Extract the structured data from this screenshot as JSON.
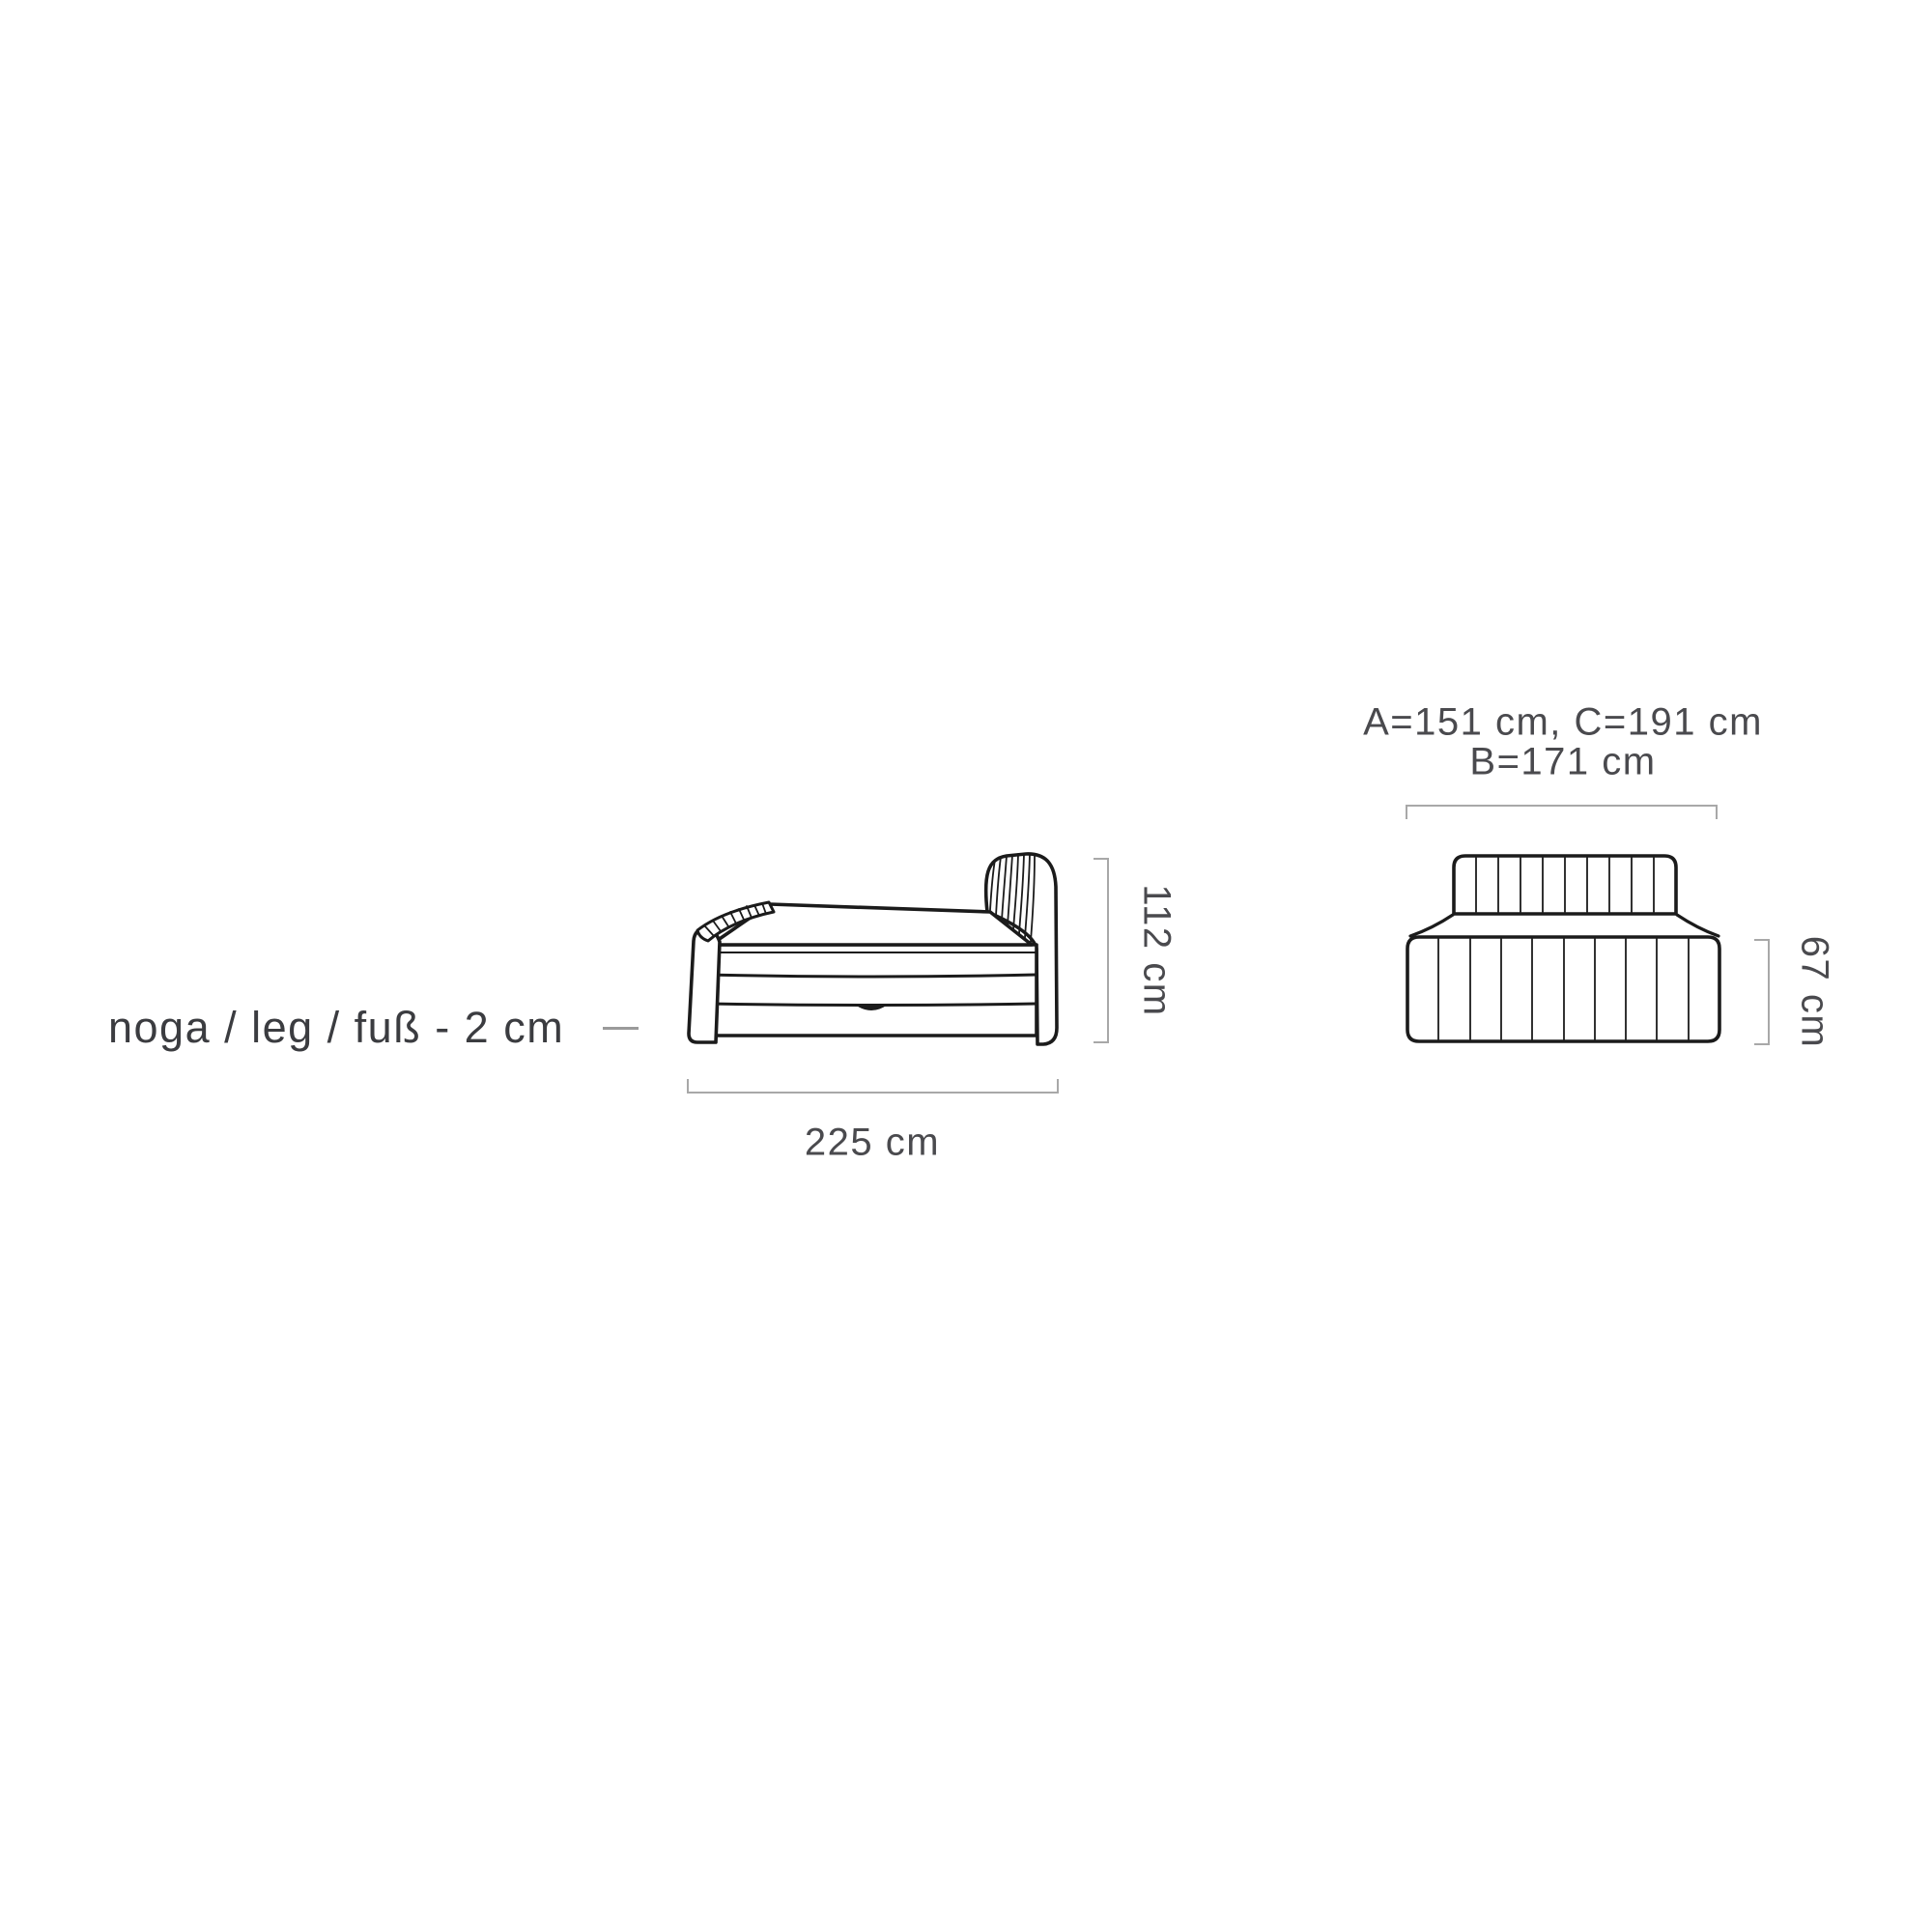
{
  "diagram": {
    "leg_note": {
      "text": "noga / leg / fuß  - 2 cm"
    },
    "side_view": {
      "name": "bed side view with storage drawer",
      "width_label": "225 cm",
      "height_label": "112 cm"
    },
    "front_view": {
      "name": "bed front view (headboard and base)",
      "width_labels_line1": "A=151 cm, C=191 cm",
      "width_labels_line2": "B=171 cm",
      "height_label": "67 cm"
    },
    "measurements": {
      "length_cm": 225,
      "total_height_cm": 112,
      "base_height_cm": 67,
      "leg_height_cm": 2,
      "width_A_cm": 151,
      "width_B_cm": 171,
      "width_C_cm": 191
    },
    "colors": {
      "drawing_line": "#1b1b1b",
      "dimension_line": "#a8a8a8",
      "text": "#3f4045",
      "background": "#ffffff"
    }
  }
}
